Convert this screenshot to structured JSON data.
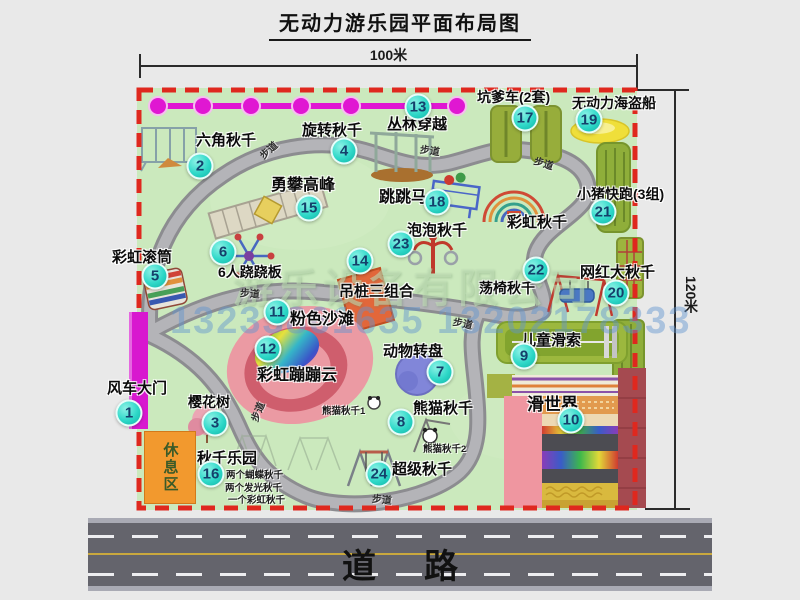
{
  "header": {
    "title": "无动力游乐园平面布局图"
  },
  "dimensions": {
    "top": "100米",
    "right": "120米"
  },
  "road": {
    "label": "道路"
  },
  "watermark": {
    "company": "游乐设备有限公司",
    "phone": "13233861635 13202178333"
  },
  "rest_area": {
    "label": "休息区"
  },
  "colors": {
    "map_green": "#cbe9bd",
    "border_red": "#df281e",
    "badge_teal": "#2ed8c8",
    "gate_magenta": "#d818cf",
    "path_gray": "#a9a9ad",
    "road_asphalt": "#64646c",
    "accent_orange": "#f2992e",
    "olive_green": "#97ad3b",
    "lane_yellow": "#c9a83e",
    "watermark_blue": "#6094d0"
  },
  "attractions": [
    {
      "key": "windmill-gate",
      "num": "1",
      "name": "风车大门",
      "fs": 15,
      "label": [
        107,
        381
      ],
      "badge": [
        129,
        413
      ]
    },
    {
      "key": "hex-swing",
      "num": "2",
      "name": "六角秋千",
      "fs": 15,
      "label": [
        196,
        133
      ],
      "badge": [
        200,
        166
      ]
    },
    {
      "key": "cherry-tree",
      "num": "3",
      "name": "樱花树",
      "fs": 14,
      "label": [
        188,
        395
      ],
      "badge": [
        215,
        423
      ]
    },
    {
      "key": "rotating-swing",
      "num": "4",
      "name": "旋转秋千",
      "fs": 15,
      "label": [
        302,
        123
      ],
      "badge": [
        344,
        151
      ]
    },
    {
      "key": "rainbow-roller",
      "num": "5",
      "name": "彩虹滚筒",
      "fs": 15,
      "label": [
        112,
        250
      ],
      "badge": [
        155,
        276
      ]
    },
    {
      "key": "six-seesaw",
      "num": "6",
      "name": "6人跷跷板",
      "fs": 14,
      "label": [
        218,
        265
      ],
      "badge": [
        223,
        252
      ]
    },
    {
      "key": "animal-carousel",
      "num": "7",
      "name": "动物转盘",
      "fs": 15,
      "label": [
        383,
        344
      ],
      "badge": [
        440,
        372
      ]
    },
    {
      "key": "panda-swing",
      "num": "8",
      "name": "熊猫秋千",
      "fs": 15,
      "label": [
        413,
        401
      ],
      "badge": [
        401,
        422
      ]
    },
    {
      "key": "kids-zipline",
      "num": "9",
      "name": "儿童滑索",
      "fs": 15,
      "label": [
        521,
        333
      ],
      "badge": [
        524,
        356
      ]
    },
    {
      "key": "slide-world",
      "num": "10",
      "name": "滑世界",
      "fs": 17,
      "label": [
        527,
        396
      ],
      "badge": [
        571,
        420
      ]
    },
    {
      "key": "pink-beach",
      "num": "11",
      "name": "粉色沙滩",
      "fs": 16,
      "label": [
        290,
        311
      ],
      "badge": [
        277,
        312
      ]
    },
    {
      "key": "rainbow-cloud",
      "num": "12",
      "name": "彩虹蹦蹦云",
      "fs": 16,
      "label": [
        257,
        367
      ],
      "badge": [
        268,
        349
      ]
    },
    {
      "key": "jungle-crossing",
      "num": "13",
      "name": "丛林穿越",
      "fs": 15,
      "label": [
        387,
        117
      ],
      "badge": [
        418,
        107
      ]
    },
    {
      "key": "hanging-piles",
      "num": "14",
      "name": "吊桩三组合",
      "fs": 15,
      "label": [
        339,
        284
      ],
      "badge": [
        360,
        261
      ]
    },
    {
      "key": "climb-peak",
      "num": "15",
      "name": "勇攀高峰",
      "fs": 16,
      "label": [
        271,
        177
      ],
      "badge": [
        309,
        208
      ]
    },
    {
      "key": "swing-park",
      "num": "16",
      "name": "秋千乐园",
      "fs": 15,
      "label": [
        197,
        451
      ],
      "badge": [
        211,
        474
      ]
    },
    {
      "key": "pit-car",
      "num": "17",
      "name": "坑爹车(2套)",
      "fs": 14,
      "label": [
        477,
        90
      ],
      "badge": [
        525,
        118
      ]
    },
    {
      "key": "jump-horse",
      "num": "18",
      "name": "跳跳马",
      "fs": 16,
      "label": [
        379,
        189
      ],
      "badge": [
        437,
        202
      ]
    },
    {
      "key": "pirate-ship",
      "num": "19",
      "name": "无动力海盗船",
      "fs": 14,
      "label": [
        572,
        96
      ],
      "badge": [
        589,
        120
      ]
    },
    {
      "key": "big-swing",
      "num": "20",
      "name": "网红大秋千",
      "fs": 15,
      "label": [
        580,
        265
      ],
      "badge": [
        616,
        293
      ]
    },
    {
      "key": "piggy-run",
      "num": "21",
      "name": "小猪快跑(3组)",
      "fs": 14,
      "label": [
        577,
        187
      ],
      "badge": [
        603,
        212
      ]
    },
    {
      "key": "chair-swing",
      "num": "22",
      "name": "荡椅秋千",
      "fs": 14,
      "label": [
        479,
        281
      ],
      "badge": [
        536,
        270
      ]
    },
    {
      "key": "bubble-swing",
      "num": "23",
      "name": "泡泡秋千",
      "fs": 15,
      "label": [
        407,
        223
      ],
      "badge": [
        401,
        244
      ]
    },
    {
      "key": "super-swing",
      "num": "24",
      "name": "超级秋千",
      "fs": 15,
      "label": [
        392,
        462
      ],
      "badge": [
        379,
        474
      ]
    },
    {
      "key": "rainbow-swing",
      "num": "",
      "name": "彩虹秋千",
      "fs": 15,
      "label": [
        507,
        215
      ],
      "badge": null
    }
  ],
  "notes": [
    {
      "key": "swing-note-1",
      "text": "两个蝴蝶秋千",
      "pos": [
        226,
        467
      ]
    },
    {
      "key": "swing-note-2",
      "text": "两个发光秋千",
      "pos": [
        225,
        480
      ]
    },
    {
      "key": "swing-note-3",
      "text": "一个彩虹秋千",
      "pos": [
        228,
        492
      ]
    },
    {
      "key": "panda-note-1",
      "text": "熊猫秋千1",
      "pos": [
        322,
        403
      ]
    },
    {
      "key": "panda-note-2",
      "text": "熊猫秋千2",
      "pos": [
        423,
        441
      ]
    }
  ],
  "path_labels": [
    {
      "text": "步道",
      "pos": [
        258,
        142
      ],
      "rot": -42
    },
    {
      "text": "步道",
      "pos": [
        420,
        142
      ],
      "rot": 8
    },
    {
      "text": "步道",
      "pos": [
        534,
        155
      ],
      "rot": 18
    },
    {
      "text": "步道",
      "pos": [
        240,
        285
      ],
      "rot": 4
    },
    {
      "text": "步道",
      "pos": [
        453,
        315
      ],
      "rot": 12
    },
    {
      "text": "步道",
      "pos": [
        247,
        404
      ],
      "rot": -68
    },
    {
      "text": "步道",
      "pos": [
        372,
        491
      ],
      "rot": 6
    }
  ]
}
